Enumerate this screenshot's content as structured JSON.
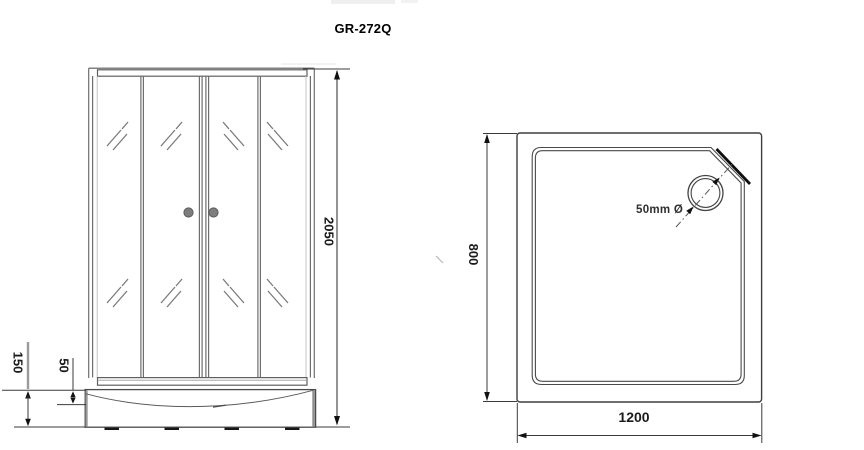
{
  "title": "GR-272Q",
  "front_view": {
    "height": "2050",
    "base_height": "150",
    "lip_height": "50"
  },
  "top_view": {
    "depth": "800",
    "width": "1200",
    "drain": "50mm Ø"
  },
  "colors": {
    "line": "#484848",
    "thick_edge": "#111111",
    "knob_gray": "#7d7d7d",
    "dim_text": "#1b1b1b",
    "background": "#ffffff"
  }
}
